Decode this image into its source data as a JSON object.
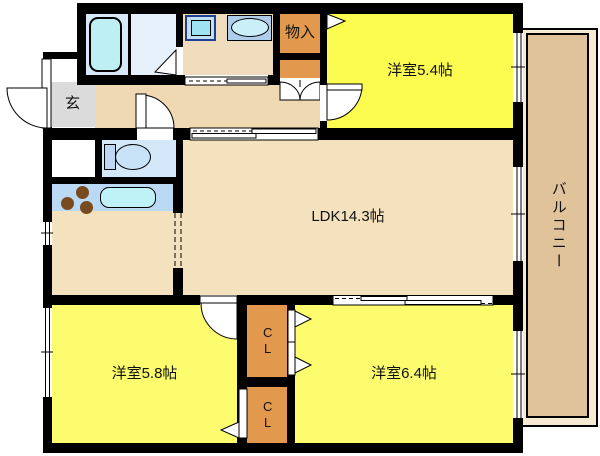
{
  "plan_type": "apartment-floor-plan",
  "labels": {
    "room54": "洋室5.4帖",
    "ldk": "LDK14.3帖",
    "room58": "洋室5.8帖",
    "room64": "洋室6.4帖",
    "balcony": "バルコニー",
    "entrance": "玄",
    "storage": "物入",
    "closet_upper": "CL",
    "closet_lower": "CL"
  },
  "fixtures": [
    "bathtub",
    "washing-machine-pan",
    "washbasin",
    "toilet",
    "stove-burners",
    "kitchen-sink"
  ],
  "colors": {
    "wall": "#000000",
    "room_yellow_upper": "#FCFB4F",
    "room_yellow_lower": "#FCFC6E",
    "ldk_tan": "#F4E1BD",
    "hallway_tan": "#EFD9B3",
    "laundry_tan": "#EFDCBC",
    "storage_orange": "#E2994D",
    "entrance_gray": "#DBDBDB",
    "bathroom_blue": "#D7E9F8",
    "toilet_blue": "#D3E8F9",
    "counter_blue": "#B9D9F4",
    "fixture_cyan": "#BFF2F6",
    "balcony_tan": "#E0C29B",
    "burner_brown": "#7A4A1F"
  }
}
